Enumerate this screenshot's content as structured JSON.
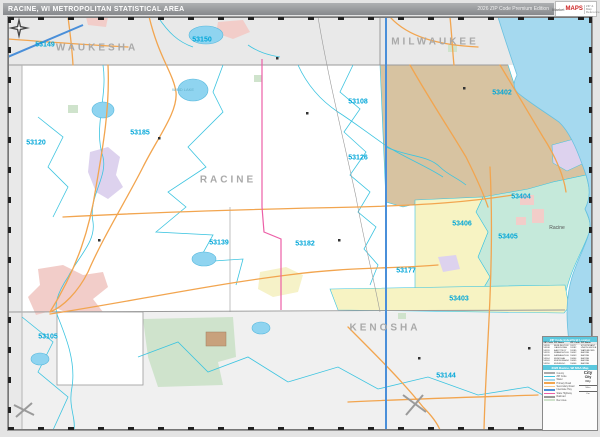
{
  "header": {
    "title": "RACINE, WI METROPOLITAN STATISTICAL AREA",
    "edition": "2026 ZIP Code Premium Edition",
    "brand": {
      "line1": "Market",
      "line2": "MAPS",
      "line3": "ZIP & Map Reference"
    }
  },
  "map": {
    "colors": {
      "outside_county": "#e9e9e9",
      "racine_county": "#ffffff",
      "kenosha_county": "#f0f0f0",
      "lake": "#a5d9ef",
      "zip_tan": "#d7c3a1",
      "zip_yellow": "#f7f3c3",
      "zip_teal": "#c5e9da",
      "zip_lavender": "#ddd2ee",
      "urban_pink": "#f2cdc9",
      "rec_green": "#cfe3cc",
      "boundary_cyan": "#3cc4e0",
      "road_orange": "#f2a54f",
      "road_magenta": "#ec5fa7",
      "road_blue": "#4a8fd9",
      "rail_gray": "#999999",
      "zip_label": "#00a6d8",
      "county_label": "#a9a9a9"
    },
    "county_labels": [
      {
        "text": "WAUKESHA",
        "x": 89,
        "y": 31
      },
      {
        "text": "MILWAUKEE",
        "x": 427,
        "y": 25
      },
      {
        "text": "RACINE",
        "x": 220,
        "y": 163
      },
      {
        "text": "KENOSHA",
        "x": 377,
        "y": 311
      }
    ],
    "zip_labels": [
      {
        "code": "53149",
        "x": 37,
        "y": 28
      },
      {
        "code": "53150",
        "x": 194,
        "y": 23
      },
      {
        "code": "53120",
        "x": 28,
        "y": 126
      },
      {
        "code": "53185",
        "x": 132,
        "y": 116
      },
      {
        "code": "53108",
        "x": 350,
        "y": 85
      },
      {
        "code": "53126",
        "x": 350,
        "y": 141
      },
      {
        "code": "53105",
        "x": 40,
        "y": 320
      },
      {
        "code": "53139",
        "x": 211,
        "y": 226
      },
      {
        "code": "53182",
        "x": 297,
        "y": 227
      },
      {
        "code": "53177",
        "x": 398,
        "y": 254
      },
      {
        "code": "53402",
        "x": 494,
        "y": 76
      },
      {
        "code": "53404",
        "x": 513,
        "y": 180
      },
      {
        "code": "53405",
        "x": 500,
        "y": 220
      },
      {
        "code": "53406",
        "x": 454,
        "y": 207
      },
      {
        "code": "53403",
        "x": 451,
        "y": 282
      },
      {
        "code": "53144",
        "x": 438,
        "y": 359
      }
    ],
    "city_labels": [
      {
        "text": "Racine",
        "x": 549,
        "y": 211
      }
    ],
    "water_labels": [
      {
        "text": "WIND LAKE",
        "x": 175,
        "y": 73
      }
    ]
  },
  "legend": {
    "index_title": "ZIP Code Index/Grid Locator",
    "map_title": "2026 Racine, WI MSA Map",
    "index_columns": [
      "ZIP Code",
      "ZIP Name"
    ],
    "index_left": [
      {
        "zip": "53105",
        "name": "BURLINGTON"
      },
      {
        "zip": "53108",
        "name": "CALEDONIA"
      },
      {
        "zip": "53120",
        "name": "EAST TROY"
      },
      {
        "zip": "53126",
        "name": "FRANKSVILLE"
      },
      {
        "zip": "53139",
        "name": "KANSASVILLE"
      },
      {
        "zip": "53144",
        "name": "KENOSHA"
      },
      {
        "zip": "53149",
        "name": "MUKWONAGO"
      },
      {
        "zip": "53150",
        "name": "MUSKEGO"
      }
    ],
    "index_right": [
      {
        "zip": "53177",
        "name": "STURTEVANT"
      },
      {
        "zip": "53182",
        "name": "UNION GROVE"
      },
      {
        "zip": "53185",
        "name": "WATERFORD"
      },
      {
        "zip": "53402",
        "name": "RACINE"
      },
      {
        "zip": "53403",
        "name": "RACINE"
      },
      {
        "zip": "53404",
        "name": "RACINE"
      },
      {
        "zip": "53405",
        "name": "RACINE"
      },
      {
        "zip": "53406",
        "name": "RACINE"
      }
    ],
    "items": [
      {
        "label": "County",
        "color": "#aaaaaa"
      },
      {
        "label": "ZIP Code",
        "color": "#3cc4e0"
      },
      {
        "label": "Water",
        "color": "#a5d9ef"
      },
      {
        "label": "Primary Road",
        "color": "#f2a54f"
      },
      {
        "label": "Secondary Road",
        "color": "#f6c98e"
      },
      {
        "label": "Interstate Hwy",
        "color": "#4a8fd9"
      },
      {
        "label": "State Highway",
        "color": "#ec5fa7"
      },
      {
        "label": "Railroad",
        "color": "#999999"
      },
      {
        "label": "Rec Area",
        "color": "#cfe3cc"
      }
    ],
    "city_samples": [
      "City",
      "City",
      "City"
    ],
    "scale_miles": "Miles",
    "scale_km": "Km"
  }
}
